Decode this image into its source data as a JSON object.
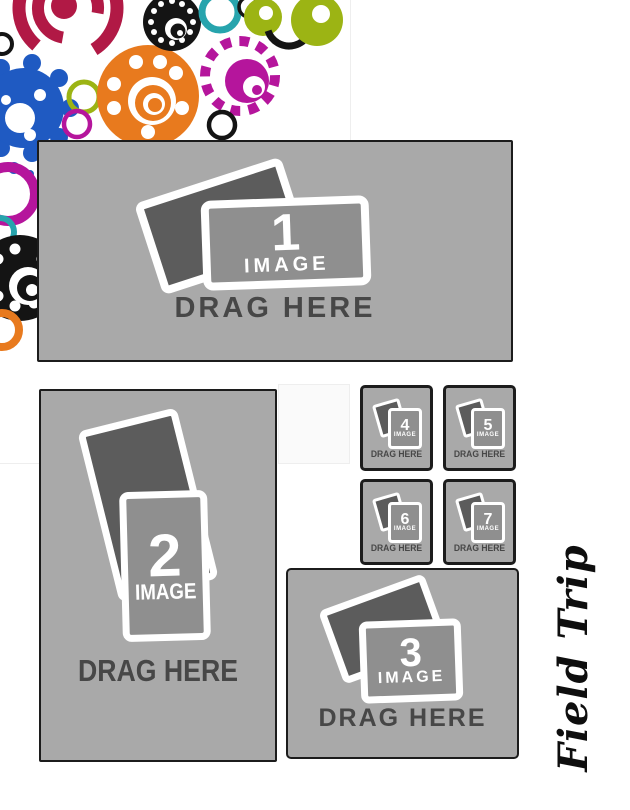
{
  "page": {
    "title": "Field Trip",
    "background": "#ffffff"
  },
  "palette": {
    "zoneBg": "#a9a9a9",
    "zoneBorder": "#1c1c1c",
    "cardBack": "#5c5c5c",
    "cardFront": "#8f8f8f",
    "cardOutline": "#ffffff",
    "dragText": "#474747",
    "titleColor": "#0e0e0e",
    "guideLine": "#eeeeee",
    "guideFill": "#fafafa",
    "artCrimson": "#b11945",
    "artOrange": "#e87a1e",
    "artMagenta": "#b5159c",
    "artBlue": "#1f5ac2",
    "artOlive": "#9cb414",
    "artTeal": "#27a4ad",
    "artBlack": "#141414"
  },
  "zones": [
    {
      "number": "1",
      "image_label": "IMAGE",
      "drag_label": "DRAG HERE"
    },
    {
      "number": "2",
      "image_label": "IMAGE",
      "drag_label": "DRAG HERE"
    },
    {
      "number": "3",
      "image_label": "IMAGE",
      "drag_label": "DRAG HERE"
    },
    {
      "number": "4",
      "image_label": "IMAGE",
      "drag_label": "DRAG HERE"
    },
    {
      "number": "5",
      "image_label": "IMAGE",
      "drag_label": "DRAG HERE"
    },
    {
      "number": "6",
      "image_label": "IMAGE",
      "drag_label": "DRAG HERE"
    },
    {
      "number": "7",
      "image_label": "IMAGE",
      "drag_label": "DRAG HERE"
    }
  ],
  "decoration": {
    "description": "cluster of colorful circles and gears, top-left corner",
    "colors": [
      "#b11945",
      "#e87a1e",
      "#b5159c",
      "#1f5ac2",
      "#9cb414",
      "#27a4ad",
      "#141414"
    ]
  }
}
